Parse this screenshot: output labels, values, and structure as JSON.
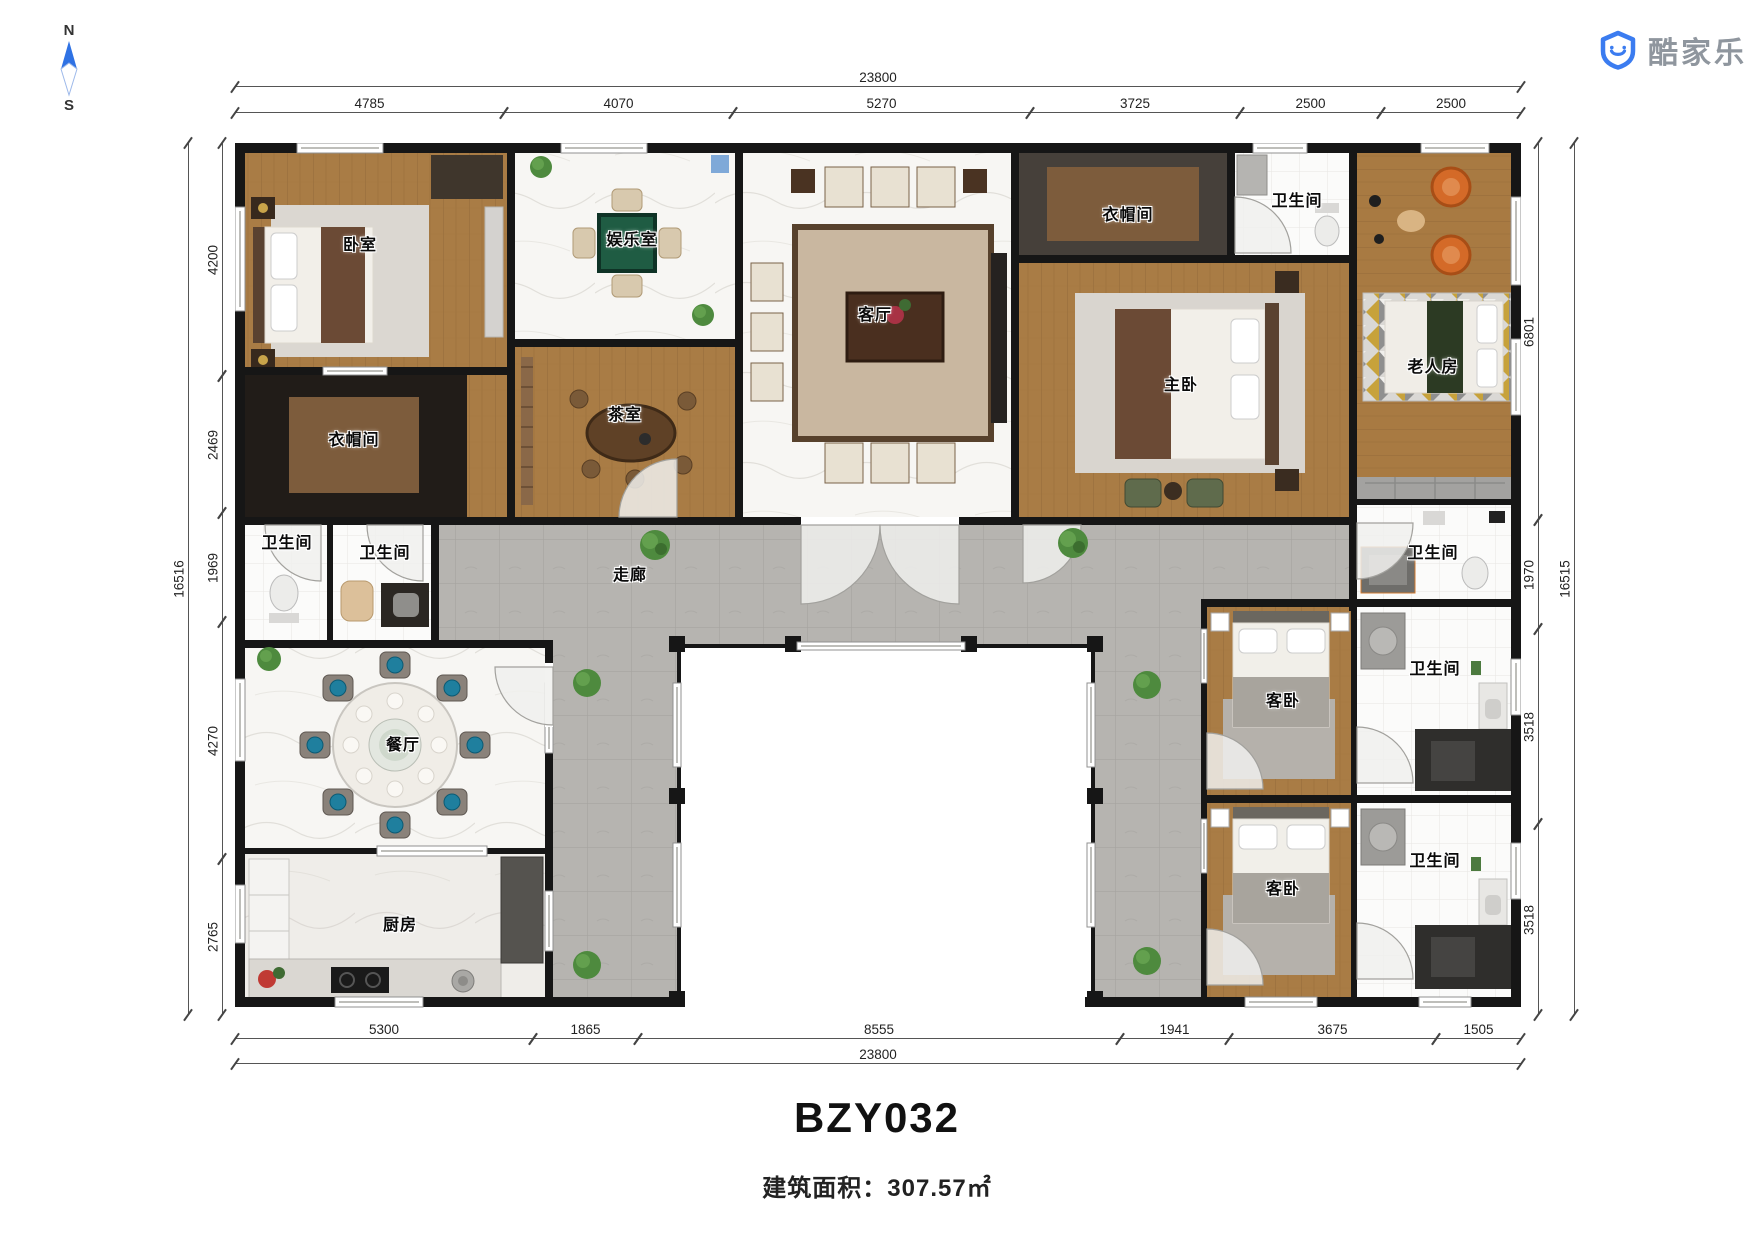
{
  "compass": {
    "north": "N",
    "south": "S"
  },
  "logo": {
    "brand": "酷家乐"
  },
  "title": {
    "model": "BZY032",
    "area": "建筑面积：307.57㎡"
  },
  "rooms": {
    "bedroom": {
      "label": "卧室"
    },
    "cloakroom_left": {
      "label": "衣帽间"
    },
    "entertainment": {
      "label": "娱乐室"
    },
    "tea_room": {
      "label": "茶室"
    },
    "living_room": {
      "label": "客厅"
    },
    "cloakroom_right": {
      "label": "衣帽间"
    },
    "bathroom_top_right": {
      "label": "卫生间"
    },
    "master_bedroom": {
      "label": "主卧"
    },
    "elder_room": {
      "label": "老人房"
    },
    "bathroom_right_mid": {
      "label": "卫生间"
    },
    "bathroom_left_1": {
      "label": "卫生间"
    },
    "bathroom_left_2": {
      "label": "卫生间"
    },
    "corridor": {
      "label": "走廊"
    },
    "dining_room": {
      "label": "餐厅"
    },
    "kitchen": {
      "label": "厨房"
    },
    "guest_bedroom_1": {
      "label": "客卧"
    },
    "guest_bedroom_2": {
      "label": "客卧"
    },
    "bathroom_right_1": {
      "label": "卫生间"
    },
    "bathroom_right_2": {
      "label": "卫生间"
    }
  },
  "dimensions": {
    "top": {
      "total": "23800",
      "segments": [
        "4785",
        "4070",
        "5270",
        "3725",
        "2500",
        "2500"
      ]
    },
    "bottom": {
      "total": "23800",
      "segments": [
        "5300",
        "1865",
        "8555",
        "1941",
        "3675",
        "1505"
      ]
    },
    "left": {
      "total": "16516",
      "segments": [
        "4200",
        "2469",
        "1969",
        "4270",
        "2765"
      ]
    },
    "right": {
      "total": "16515",
      "segments": [
        "6801",
        "1970",
        "3518",
        "3518"
      ]
    }
  },
  "colors": {
    "wall": "#161616",
    "wood": "#a97c45",
    "marble": "#f7f6f3",
    "corridor_tile": "#b6b4b0",
    "dark_floor": "#211c18",
    "accent_blue": "#3b7cf0"
  }
}
